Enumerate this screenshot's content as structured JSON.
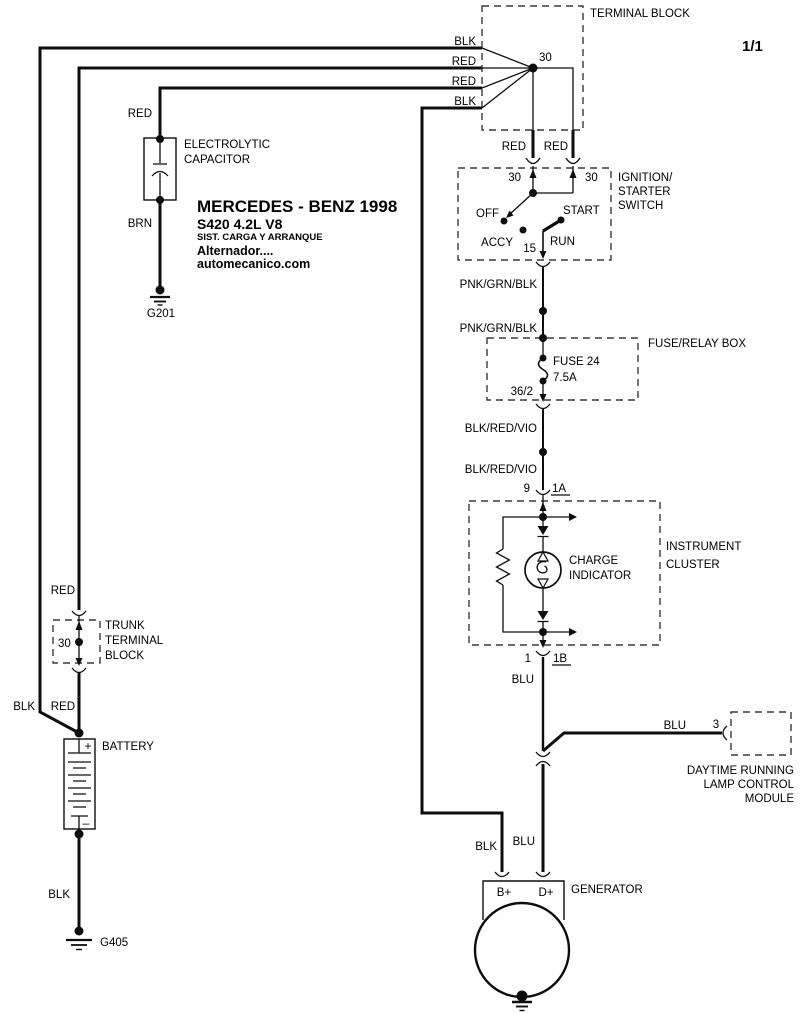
{
  "page": {
    "indicator": "1/1"
  },
  "title_block": {
    "line1": "MERCEDES - BENZ 1998",
    "line2": "S420  4.2L  V8",
    "line3": "SIST. CARGA Y ARRANQUE",
    "line4": "Alternador....",
    "line5": "automecanico.com"
  },
  "wire_labels": {
    "top_blk1": "BLK",
    "top_red1": "RED",
    "top_red2": "RED",
    "top_blk2": "BLK",
    "cap_red": "RED",
    "cap_brn": "BRN",
    "ign_red_left": "RED",
    "ign_red_right": "RED",
    "pnk_grn_blk_1": "PNK/GRN/BLK",
    "pnk_grn_blk_2": "PNK/GRN/BLK",
    "blk_red_vio_1": "BLK/RED/VIO",
    "blk_red_vio_2": "BLK/RED/VIO",
    "blu_cluster": "BLU",
    "blu_drl": "BLU",
    "blu_gen": "BLU",
    "blk_gen": "BLK",
    "trunk_red_top": "RED",
    "trunk_blk": "BLK",
    "trunk_red_bot": "RED",
    "battery_blk": "BLK"
  },
  "components": {
    "terminal_block": {
      "label": "TERMINAL BLOCK",
      "terminal_30": "30"
    },
    "capacitor": {
      "label_line1": "ELECTROLYTIC",
      "label_line2": "CAPACITOR"
    },
    "ground_g201": {
      "label": "G201"
    },
    "ignition_switch": {
      "label_line1": "IGNITION/",
      "label_line2": "STARTER",
      "label_line3": "SWITCH",
      "terminal_30_left": "30",
      "terminal_30_right": "30",
      "pos_off": "OFF",
      "pos_accy": "ACCY",
      "pos_start": "START",
      "pos_run": "RUN",
      "terminal_15": "15"
    },
    "fuse_relay_box": {
      "label": "FUSE/RELAY BOX",
      "fuse_name": "FUSE 24",
      "fuse_rating": "7.5A",
      "terminal": "36/2"
    },
    "instrument_cluster": {
      "label_line1": "INSTRUMENT",
      "label_line2": "CLUSTER",
      "indicator_line1": "CHARGE",
      "indicator_line2": "INDICATOR",
      "pin_9": "9",
      "pin_1a": "1A",
      "pin_1": "1",
      "pin_1b": "1B"
    },
    "drl_module": {
      "pin_3": "3",
      "label_line1": "DAYTIME RUNNING",
      "label_line2": "LAMP CONTROL",
      "label_line3": "MODULE"
    },
    "trunk_terminal_block": {
      "label_line1": "TRUNK",
      "label_line2": "TERMINAL",
      "label_line3": "BLOCK",
      "terminal_30": "30"
    },
    "battery": {
      "label": "BATTERY",
      "plus": "+",
      "minus": "–"
    },
    "ground_g405": {
      "label": "G405"
    },
    "generator": {
      "label": "GENERATOR",
      "terminal_b": "B+",
      "terminal_d": "D+"
    }
  }
}
